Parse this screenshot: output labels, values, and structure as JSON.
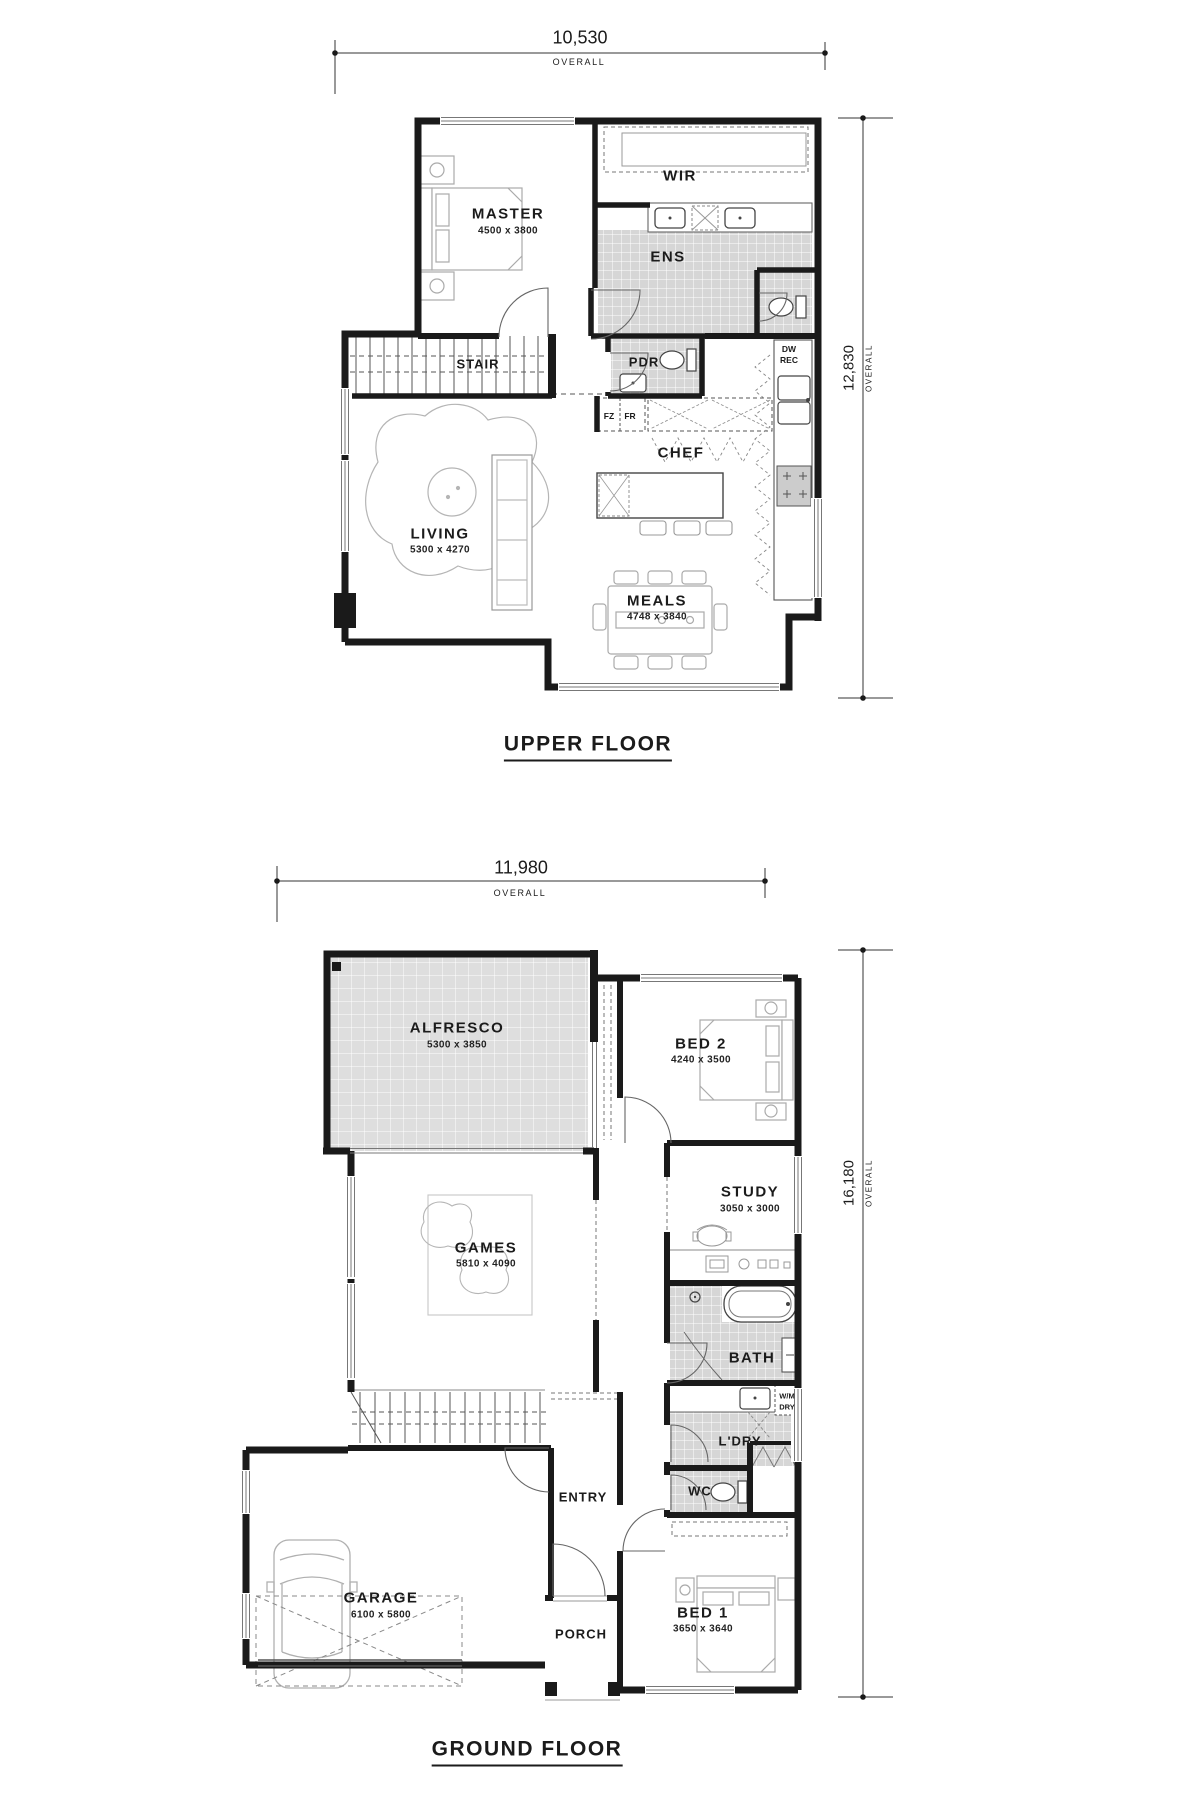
{
  "floors": {
    "upper": {
      "title": "UPPER FLOOR",
      "dim_width": {
        "value": "10,530",
        "label": "OVERALL"
      },
      "dim_height": {
        "value": "12,830",
        "label": "OVERALL"
      },
      "rooms": {
        "master": {
          "name": "MASTER",
          "dims": "4500 x 3800"
        },
        "wir": {
          "name": "WIR"
        },
        "ens": {
          "name": "ENS"
        },
        "stair": {
          "name": "STAIR"
        },
        "pdr": {
          "name": "PDR"
        },
        "chef": {
          "name": "CHEF"
        },
        "living": {
          "name": "LIVING",
          "dims": "5300 x 4270"
        },
        "meals": {
          "name": "MEALS",
          "dims": "4748 x 3840"
        }
      },
      "appliances": {
        "fz": "FZ",
        "fr": "FR",
        "dw": "DW",
        "rec": "REC"
      }
    },
    "ground": {
      "title": "GROUND FLOOR",
      "dim_width": {
        "value": "11,980",
        "label": "OVERALL"
      },
      "dim_height": {
        "value": "16,180",
        "label": "OVERALL"
      },
      "rooms": {
        "alfresco": {
          "name": "ALFRESCO",
          "dims": "5300 x 3850"
        },
        "bed2": {
          "name": "BED 2",
          "dims": "4240 x 3500"
        },
        "study": {
          "name": "STUDY",
          "dims": "3050 x 3000"
        },
        "games": {
          "name": "GAMES",
          "dims": "5810 x 4090"
        },
        "bath": {
          "name": "BATH"
        },
        "ldry": {
          "name": "L'DRY"
        },
        "wc": {
          "name": "WC"
        },
        "garage": {
          "name": "GARAGE",
          "dims": "6100 x 5800"
        },
        "entry": {
          "name": "ENTRY"
        },
        "porch": {
          "name": "PORCH"
        },
        "bed1": {
          "name": "BED 1",
          "dims": "3650 x 3640"
        }
      },
      "appliances": {
        "wm": "W/M",
        "dry": "DRY"
      }
    }
  },
  "colors": {
    "wall": "#1a1a1a",
    "tile": "#d6d6d6",
    "furniture": "#b0b0b0"
  }
}
